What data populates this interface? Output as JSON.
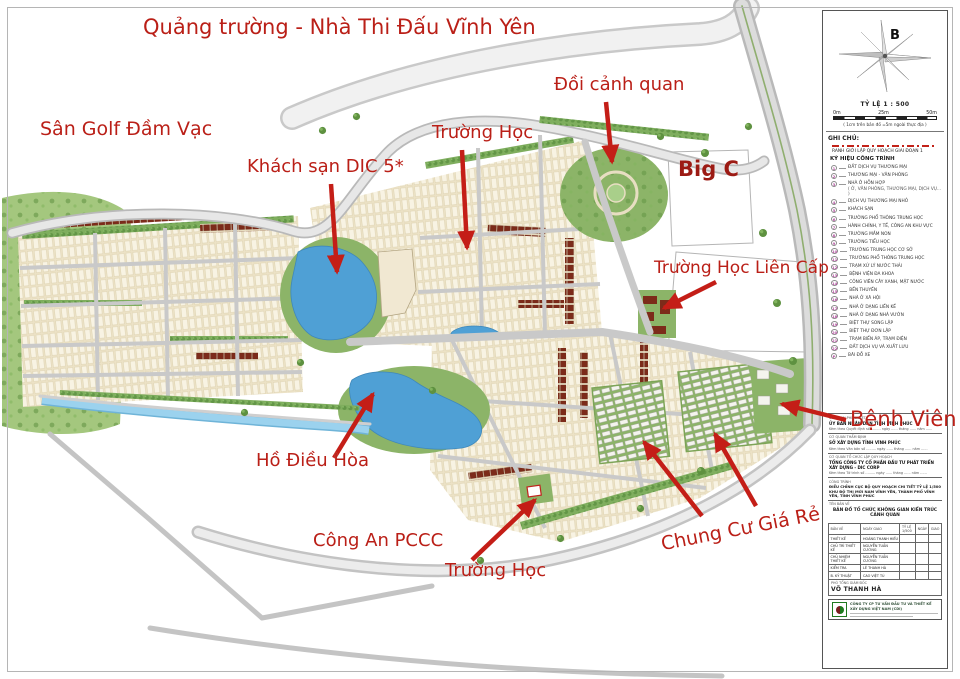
{
  "map_labels": [
    {
      "text": "Quảng trường - Nhà Thi Đấu Vĩnh Yên"
    },
    {
      "text": "Sân Golf Đầm Vạc"
    },
    {
      "text": "Khách sạn DIC 5*"
    },
    {
      "text": "Trường Học"
    },
    {
      "text": "Đồi cảnh quan"
    },
    {
      "text": "Big C"
    },
    {
      "text": "Trường Học Liên Cấp"
    },
    {
      "text": "Bệnh Viên"
    },
    {
      "text": "Hồ Điều Hòa"
    },
    {
      "text": "Công An PCCC"
    },
    {
      "text": "Trường Học"
    },
    {
      "text": "Chung Cư Giá Rẻ"
    }
  ],
  "colors": {
    "label_red": "#ba1f17",
    "arrow_red": "#c41e17",
    "water_blue": "#4fa0d5",
    "legend_number_pink": "#b14c9e",
    "park_green": "#8cb468",
    "lot_beige": "#ece2c6",
    "roof_dark_red": "#7c2b1a"
  },
  "panel": {
    "compass_letter": "B",
    "scale_title": "TỶ LỆ 1 : 500",
    "scale_ticks": [
      "0m",
      "25m",
      "50m"
    ],
    "scale_note": "( 1cm trên bản đồ =5m ngoài thực địa )",
    "notes_title": "GHI CHÚ:",
    "boundary_label": "RANH GIỚI LẬP QUY HOẠCH GIAI ĐOẠN 1",
    "legend_title": "KÝ HIỆU CÔNG TRÌNH",
    "legend": [
      {
        "num": "1",
        "label": "ĐẤT DỊCH VỤ THƯƠNG MẠI"
      },
      {
        "num": "2",
        "label": "THƯƠNG MẠI - VĂN PHÒNG"
      },
      {
        "num": "3",
        "label": "NHÀ Ở HỖN HỢP",
        "sub": "( Ở, VĂN PHÒNG, THƯƠNG MẠI, DỊCH VỤ... )"
      },
      {
        "num": "4",
        "label": "DỊCH VỤ THƯƠNG MẠI NHỎ"
      },
      {
        "num": "5",
        "label": "KHÁCH SẠN"
      },
      {
        "num": "6",
        "label": "TRƯỜNG PHỔ THÔNG TRUNG HỌC"
      },
      {
        "num": "7",
        "label": "HÀNH CHÍNH, Y TẾ, CÔNG AN KHU VỰC"
      },
      {
        "num": "8",
        "label": "TRƯỜNG MẦM NON"
      },
      {
        "num": "9",
        "label": "TRƯỜNG TIỂU HỌC"
      },
      {
        "num": "10",
        "label": "TRƯỜNG TRUNG HỌC CƠ SỞ"
      },
      {
        "num": "11",
        "label": "TRƯỜNG PHỔ THÔNG TRUNG HỌC"
      },
      {
        "num": "12",
        "label": "TRẠM XỬ LÝ NƯỚC THẢI"
      },
      {
        "num": "13",
        "label": "BỆNH VIỆN ĐA KHOA"
      },
      {
        "num": "14",
        "label": "CÔNG VIÊN CÂY XANH, MẶT NƯỚC"
      },
      {
        "num": "15",
        "label": "BẾN THUYỀN"
      },
      {
        "num": "16",
        "label": "NHÀ Ở XÃ HỘI"
      },
      {
        "num": "17",
        "label": "NHÀ Ở DẠNG LIỀN KỀ"
      },
      {
        "num": "18",
        "label": "NHÀ Ở DẠNG NHÀ VƯỜN"
      },
      {
        "num": "19",
        "label": "BIỆT THỰ SONG LẬP"
      },
      {
        "num": "20",
        "label": "BIỆT THỰ ĐƠN LẬP"
      },
      {
        "num": "21",
        "label": "TRẠM BIẾN ÁP, TRẠM ĐIỆN"
      },
      {
        "num": "22",
        "label": "ĐẤT DỊCH VỤ VÀ XUẤT LƯU"
      },
      {
        "num": "P",
        "label": "BÃI ĐỖ XE"
      }
    ],
    "title_block": {
      "sections": [
        {
          "header": "CƠ QUAN PHÊ DUYỆT",
          "org": "ỦY BAN NHÂN DÂN TỈNH VĨNH PHÚC",
          "note": "Kèm theo Quyết định số ......... ngày ...... tháng ...... năm ......"
        },
        {
          "header": "CƠ QUAN THẨM ĐỊNH",
          "org": "SỞ XÂY DỰNG TỈNH VĨNH PHÚC",
          "note": "Kèm theo Văn bản số ......... ngày ...... tháng ...... năm ......"
        },
        {
          "header": "CƠ QUAN TỔ CHỨC LẬP QUY HOẠCH",
          "org": "TỔNG CÔNG TY CỔ PHẦN ĐẦU TƯ PHÁT TRIỂN XÂY DỰNG - DIC CORP",
          "note": "Kèm theo Tờ trình số ......... ngày ...... tháng ...... năm ......"
        }
      ],
      "project": {
        "header": "CÔNG TRÌNH",
        "line1": "ĐIỀU CHỈNH CỤC BỘ QUY HOẠCH CHI TIẾT TỶ LỆ 1/500",
        "line2": "KHU ĐÔ THỊ MỚI NAM VĨNH YÊN, THÀNH PHỐ VĨNH YÊN, TỈNH VĨNH PHÚC"
      },
      "drawing": {
        "header": "TÊN BẢN VẼ",
        "title": "BẢN ĐỒ TỔ CHỨC KHÔNG GIAN KIẾN TRÚC CẢNH QUAN"
      },
      "table": {
        "header": [
          "BẢN VẼ",
          "NGÀY GIAO",
          "TỶ LỆ 1/500",
          "NGÀY",
          "GIAO"
        ],
        "rows": [
          [
            "THIẾT KẾ",
            "HOÀNG THANH HIẾU"
          ],
          [
            "CHỦ TRÌ THIẾT KẾ",
            "NGUYỄN TUẤN CƯỜNG"
          ],
          [
            "CHỦ NHIỆM THIẾT KẾ",
            "NGUYỄN TUẤN CƯỜNG"
          ],
          [
            "KIỂM TRA",
            "LÊ THANH HÀ"
          ],
          [
            "B. KỸ THUẬT",
            "CAO VIỆT TÚ"
          ]
        ]
      },
      "signature": {
        "role": "PHÓ TỔNG GIÁM ĐỐC",
        "name": "VÕ THANH HÀ"
      },
      "company": "CÔNG TY CP TƯ VẤN ĐẦU TƯ VÀ THIẾT KẾ XÂY DỰNG VIỆT NAM (CDI)"
    }
  }
}
